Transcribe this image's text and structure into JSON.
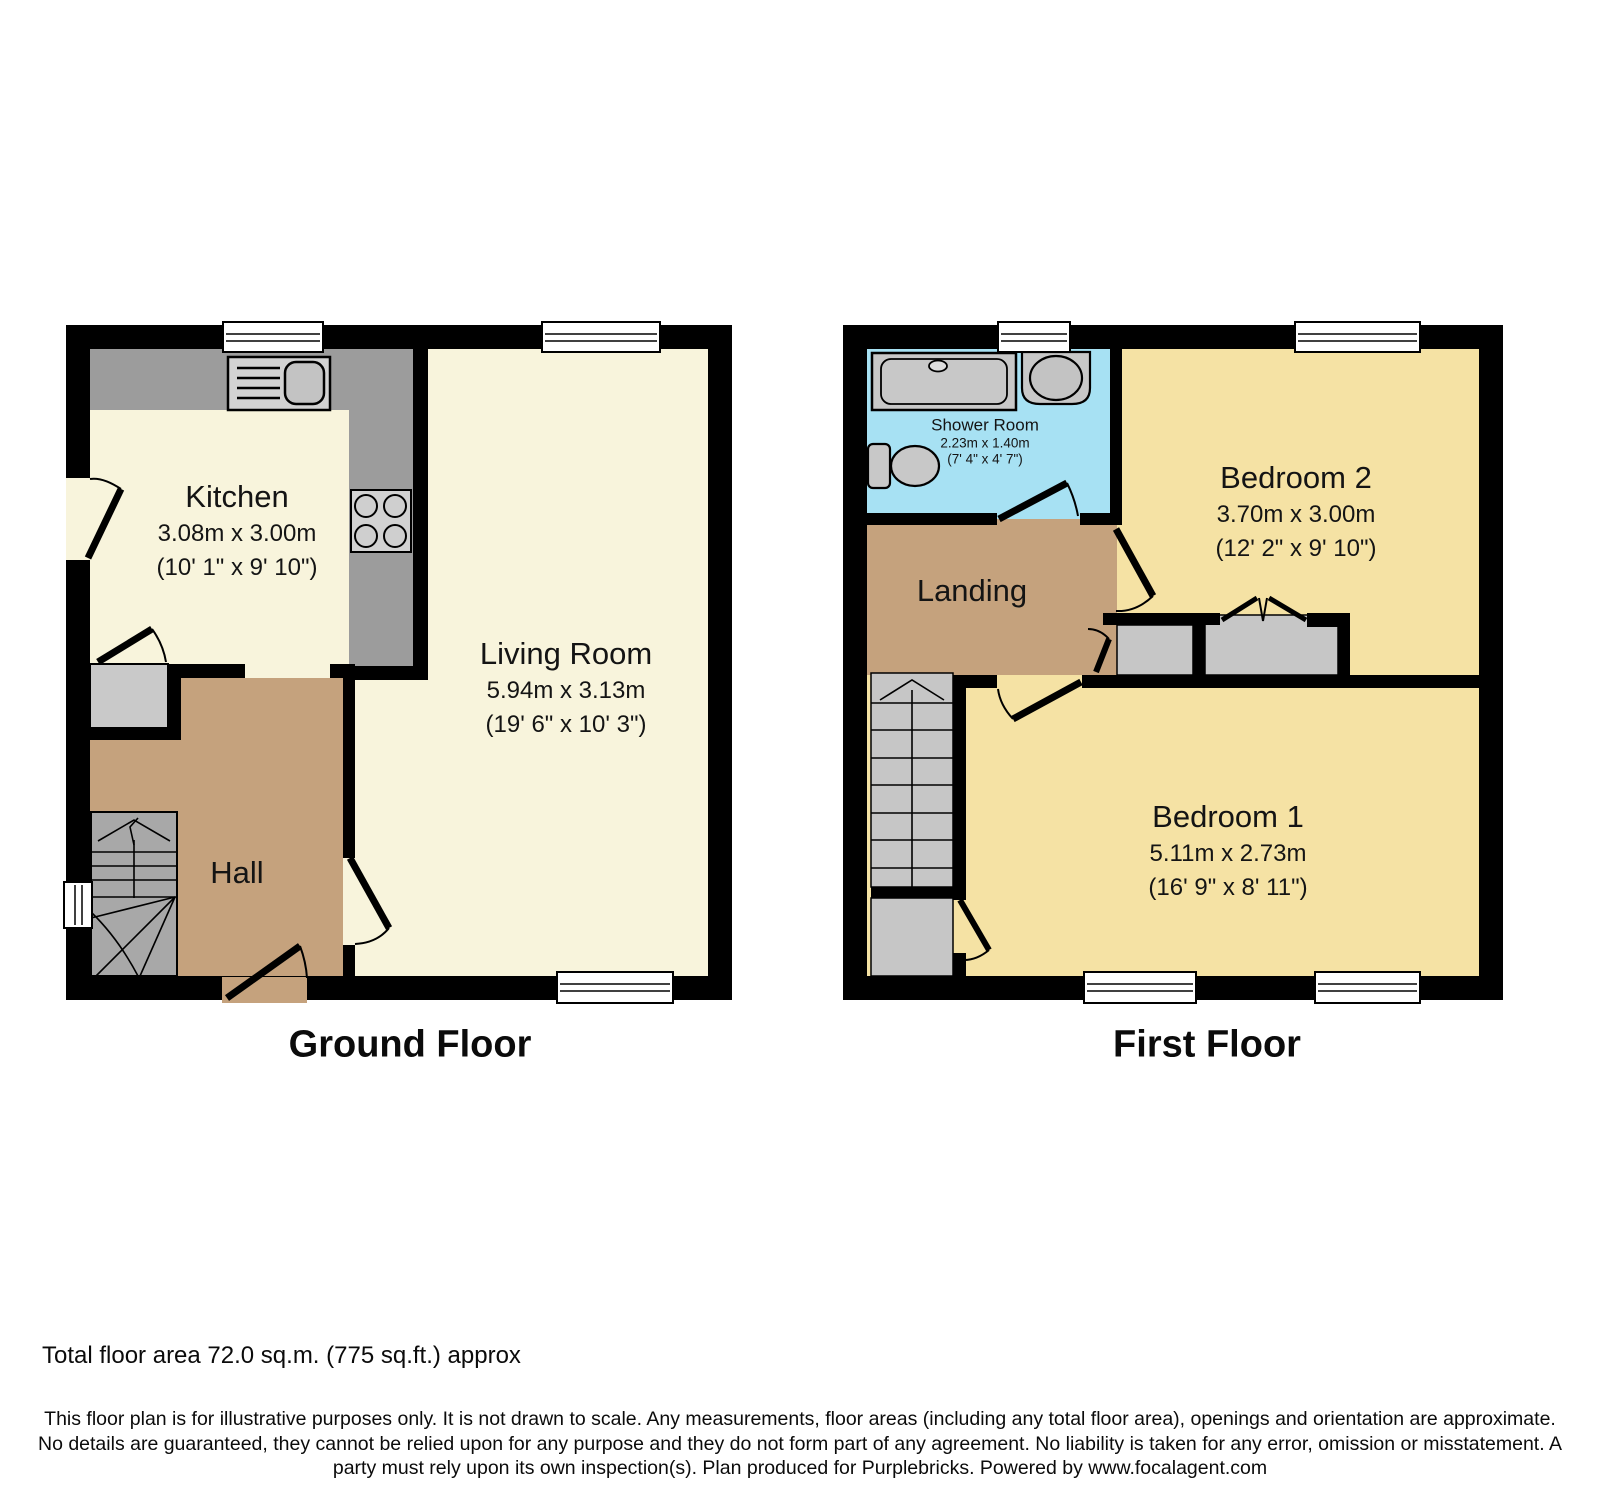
{
  "ground_floor": {
    "title": "Ground Floor",
    "rooms": {
      "kitchen": {
        "name": "Kitchen",
        "metric": "3.08m x 3.00m",
        "imperial": "(10' 1\" x 9' 10\")"
      },
      "living_room": {
        "name": "Living Room",
        "metric": "5.94m x 3.13m",
        "imperial": "(19' 6\" x 10' 3\")"
      },
      "hall": {
        "name": "Hall"
      }
    },
    "fixtures": [
      "kitchen-sink-icon",
      "hob-icon",
      "staircase-up-icon",
      "under-stairs-cupboard",
      "window-icon",
      "door-swing-icon"
    ]
  },
  "first_floor": {
    "title": "First Floor",
    "rooms": {
      "shower_room": {
        "name": "Shower Room",
        "metric": "2.23m x 1.40m",
        "imperial": "(7' 4\" x 4' 7\")"
      },
      "bedroom_2": {
        "name": "Bedroom 2",
        "metric": "3.70m x 3.00m",
        "imperial": "(12' 2\" x 9' 10\")"
      },
      "landing": {
        "name": "Landing"
      },
      "bedroom_1": {
        "name": "Bedroom 1",
        "metric": "5.11m x 2.73m",
        "imperial": "(16' 9\" x 8' 11\")"
      }
    },
    "fixtures": [
      "shower-tray-icon",
      "basin-icon",
      "toilet-icon",
      "staircase-down-icon",
      "closet",
      "bifold-door-icon",
      "window-icon",
      "door-swing-icon"
    ]
  },
  "footer": {
    "total_area": "Total floor area 72.0 sq.m. (775 sq.ft.) approx",
    "disclaimer": "This floor plan is for illustrative purposes only. It is not drawn to scale. Any measurements, floor areas (including any total floor area), openings and orientation are approximate. No details are guaranteed, they cannot be relied upon for any purpose and they do not form part of any agreement. No liability is taken for any error, omission or misstatement. A party must rely upon its own inspection(s). Plan produced for Purplebricks. Powered by www.focalagent.com"
  },
  "colors": {
    "wall": "#000000",
    "ground_room_floor": "#f8f4dc",
    "bedroom_floor": "#f5e2a4",
    "hall_landing_floor": "#c5a27d",
    "shower_room_floor": "#a7e1f3",
    "counter": "#9c9c9c",
    "fixture_light": "#d2d2d2",
    "fixture_mid": "#c6c6c6",
    "stairs_ground": "#a8a8a8",
    "stairs_first": "#c6c6c6",
    "window": "#ffffff"
  }
}
